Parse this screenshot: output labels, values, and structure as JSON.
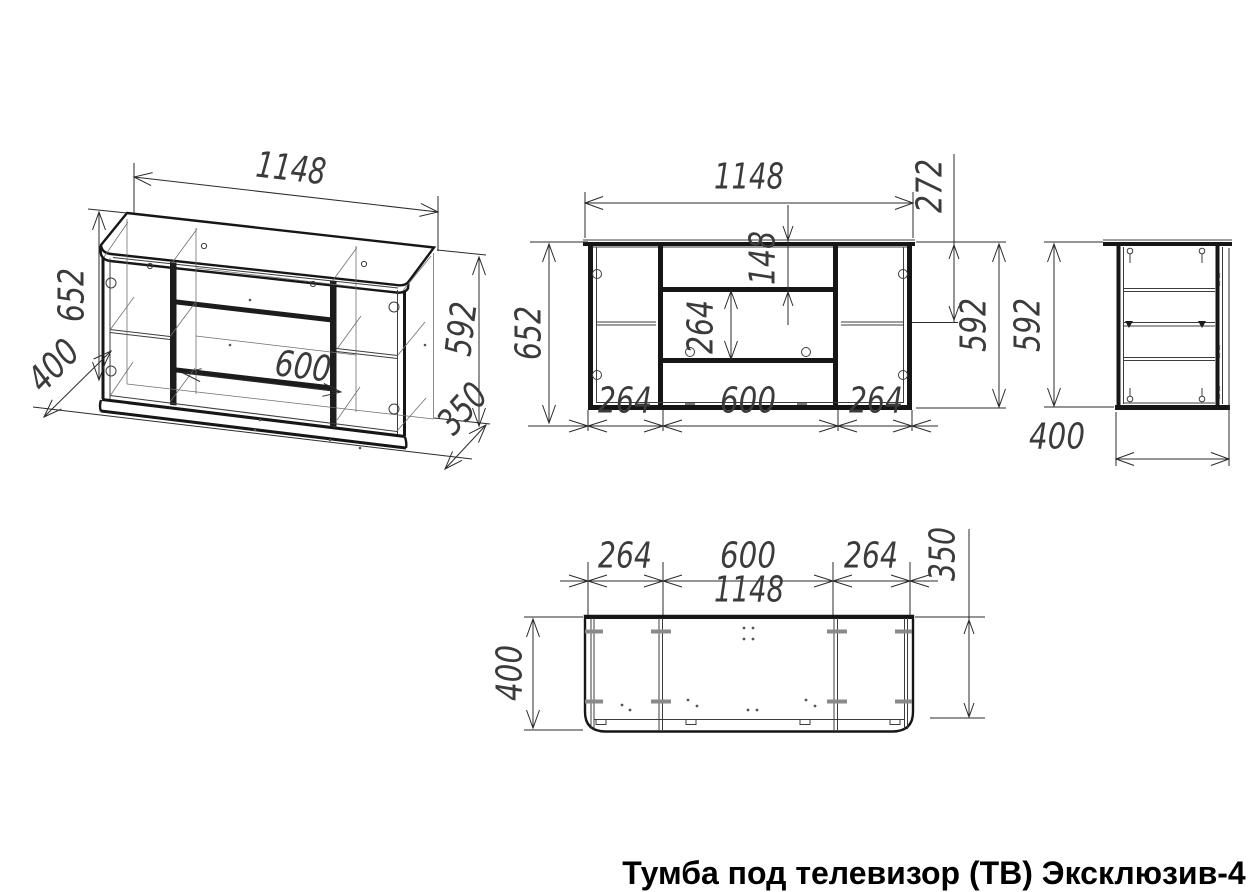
{
  "title": "Тумба под телевизор (ТВ) Эксклюзив-4",
  "isometric": {
    "width": "1148",
    "height_total": "652",
    "depth": "400",
    "niche_width": "600",
    "height_carcass": "592",
    "base_depth": "350"
  },
  "front": {
    "width": "1148",
    "top_corner_offset": "272",
    "niche_top": "148",
    "niche_height": "264",
    "height_total": "652",
    "height_carcass": "592",
    "section_left": "264",
    "section_middle": "600",
    "section_right": "264"
  },
  "side": {
    "height": "592",
    "depth": "400"
  },
  "plan": {
    "section_left": "264",
    "section_middle": "600",
    "section_right": "264",
    "width": "1148",
    "base_depth": "350",
    "depth": "400"
  }
}
